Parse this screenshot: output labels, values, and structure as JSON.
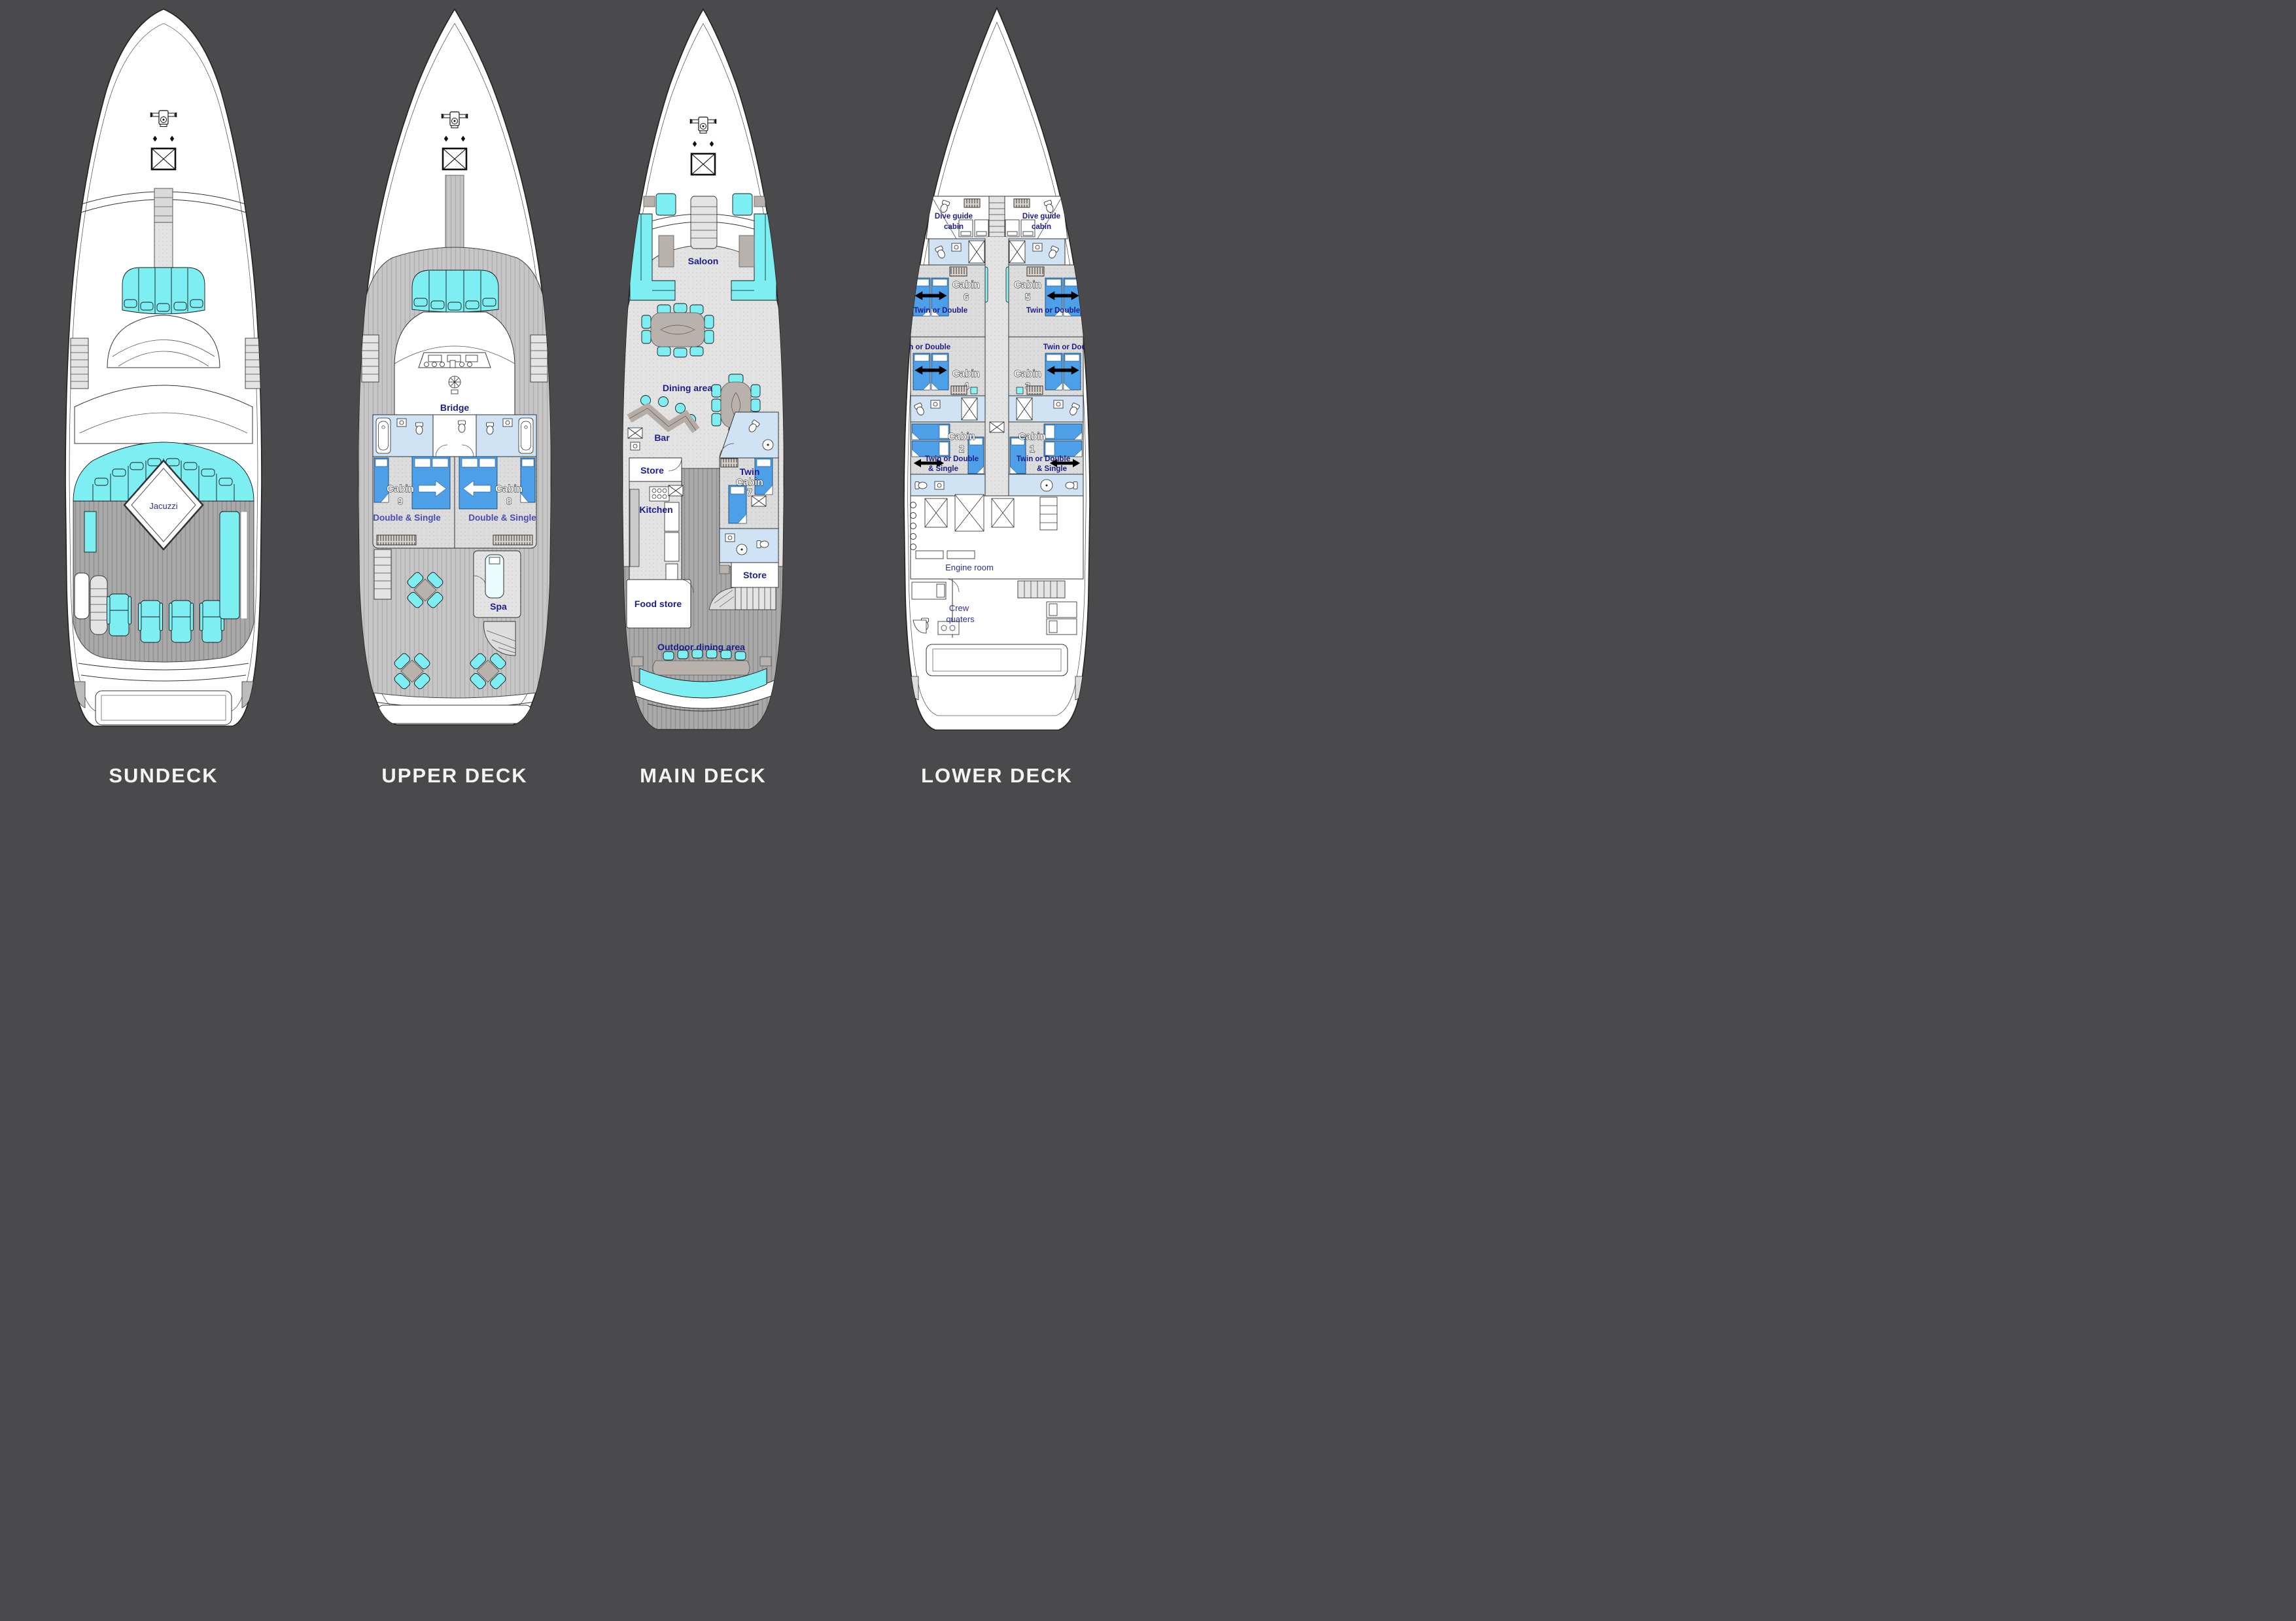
{
  "page": {
    "background": "#4a4a4c"
  },
  "palette": {
    "hull": "#ffffff",
    "outline": "#222222",
    "teak_light": "#c6c6c6",
    "teak_dark": "#ababab",
    "aqua_furniture": "#7deef2",
    "skylight": "#8ff0f4",
    "room_blue": "#cfe3f5",
    "bed_blue": "#4d9fe8",
    "table_gray": "#b9b2ac",
    "label_navy": "#1c1c8c",
    "label_indigo": "#4a4ab8",
    "title_white": "#f4f4f4"
  },
  "decks": {
    "sundeck": {
      "title": "SUNDECK",
      "rooms": {
        "jacuzzi": "Jacuzzi"
      }
    },
    "upper": {
      "title": "UPPER DECK",
      "rooms": {
        "bridge": "Bridge",
        "cabin9_name": "Cabin",
        "cabin9_num": "9",
        "cabin9_type": "Double & Single",
        "cabin8_name": "Cabin",
        "cabin8_num": "8",
        "cabin8_type": "Double & Single",
        "spa": "Spa"
      }
    },
    "main": {
      "title": "MAIN DECK",
      "rooms": {
        "saloon": "Saloon",
        "dining": "Dining area",
        "bar": "Bar",
        "store_fwd": "Store",
        "kitchen": "Kitchen",
        "cabin7_l1": "Twin",
        "cabin7_l2": "Cabin",
        "cabin7_num": "7",
        "store_aft": "Store",
        "food_store": "Food store",
        "outdoor_dining": "Outdoor dining area"
      }
    },
    "lower": {
      "title": "LOWER DECK",
      "rooms": {
        "dive_l1": "Dive guide",
        "dive_l2": "cabin",
        "cabin6_name": "Cabin",
        "cabin6_num": "6",
        "cabin5_name": "Cabin",
        "cabin5_num": "5",
        "cabin4_name": "Cabin",
        "cabin4_num": "4",
        "cabin3_name": "Cabin",
        "cabin3_num": "3",
        "cabin2_name": "Cabin",
        "cabin2_num": "2",
        "cabin1_name": "Cabin",
        "cabin1_num": "1",
        "twin_or_double": "Twin or Double",
        "and_single": "& Single",
        "engine_room": "Engine room",
        "crew_l1": "Crew",
        "crew_l2": "quaters"
      }
    }
  }
}
